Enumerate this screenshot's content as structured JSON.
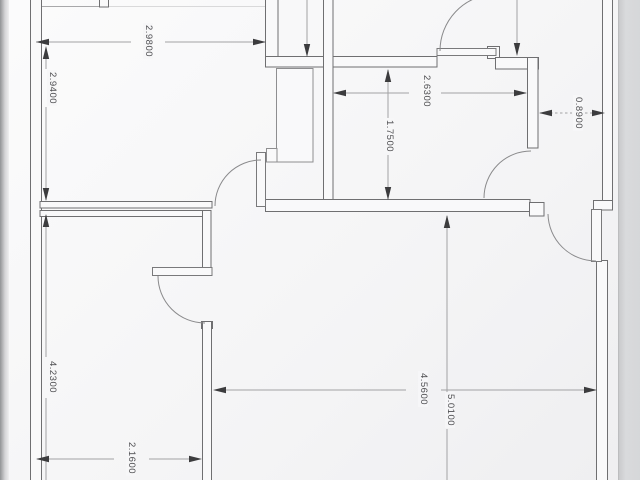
{
  "plan": {
    "dims": [
      {
        "id": "top-left-room-width",
        "value": "2.9800",
        "orientation": "horizontal"
      },
      {
        "id": "top-left-room-height",
        "value": "2.9400",
        "orientation": "vertical"
      },
      {
        "id": "bathroom-width",
        "value": "2.6300",
        "orientation": "horizontal"
      },
      {
        "id": "bathroom-height",
        "value": "1.7500",
        "orientation": "vertical"
      },
      {
        "id": "hallway-width",
        "value": "0.8900",
        "orientation": "horizontal"
      },
      {
        "id": "lower-left-room-height",
        "value": "4.2300",
        "orientation": "vertical"
      },
      {
        "id": "lower-left-room-width",
        "value": "2.1600",
        "orientation": "horizontal"
      },
      {
        "id": "living-room-width",
        "value": "4.5600",
        "orientation": "horizontal"
      },
      {
        "id": "living-room-height",
        "value": "5.0100",
        "orientation": "vertical"
      }
    ],
    "colors": {
      "paper": "#f6f6f7",
      "backdrop_left": "#929395",
      "backdrop_right": "#d7d8da",
      "wall_line": "#6f6f71",
      "fixture_line": "#8e8e90",
      "dim_line": "#a2a2a4",
      "arrow": "#3c3c3e",
      "dim_text": "#4f4f52"
    }
  }
}
